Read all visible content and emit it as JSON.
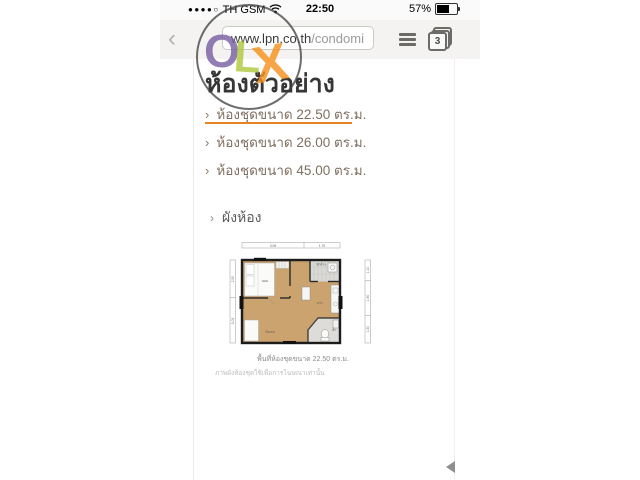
{
  "status_bar": {
    "signal_dots": "●●●●○",
    "carrier": "TH GSM",
    "time": "22:50",
    "battery_percent": "57%"
  },
  "browser": {
    "back_glyph": "‹",
    "url_host": "www.lpn.co.th",
    "url_path": "/condomi",
    "tab_count": "3"
  },
  "watermark": {
    "o": "O",
    "l": "L",
    "x": "X"
  },
  "page": {
    "title": "ห้องตัวอย่าง",
    "list_marker": "›",
    "menu_items": [
      {
        "label": "ห้องชุดขนาด 22.50 ตร.ม.",
        "active": true
      },
      {
        "label": "ห้องชุดขนาด 26.00 ตร.ม.",
        "active": false
      },
      {
        "label": "ห้องชุดขนาด 45.00 ตร.ม.",
        "active": false
      }
    ],
    "section_title": "ผังห้อง",
    "floorplan": {
      "dims_top": [
        "3.05",
        "1.75"
      ],
      "dims_left": [
        "2.50",
        "3.05"
      ],
      "dims_right": [
        "1.10",
        "1.90",
        "1.50"
      ],
      "rooms": {
        "bedroom": "นอน",
        "balcony": "ซักล้าง",
        "kitchen": "ครัว",
        "bath": "น้ำ",
        "living": "นั่งเล่น"
      },
      "caption": "พื้นที่ห้องชุดขนาด 22.50 ตร.ม.",
      "disclaimer": "ภาพผังห้องชุดใช้เพื่อการโฆษณาเท่านั้น"
    }
  },
  "colors": {
    "accent_orange": "#e8821e",
    "olx_o": "#7b61a4",
    "olx_l": "#afc93d",
    "olx_x": "#f6921e",
    "wood_floor": "#cba36f"
  }
}
